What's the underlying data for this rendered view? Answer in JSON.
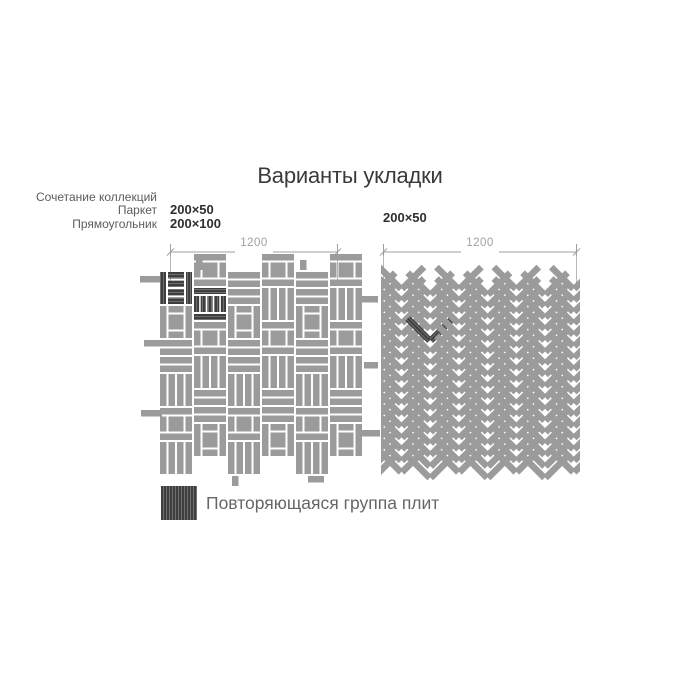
{
  "title": "Варианты укладки",
  "left_diagram": {
    "collection_label_lines": [
      "Сочетание коллекций",
      "Паркет",
      "Прямоугольник"
    ],
    "tile_sizes": [
      "200×50",
      "200×100"
    ],
    "dimension_label": "1200",
    "pattern_type": "basketweave-parquet"
  },
  "right_diagram": {
    "tile_sizes": [
      "200×50"
    ],
    "dimension_label": "1200",
    "pattern_type": "herringbone-45"
  },
  "legend": {
    "label": "Повторяющаяся группа плит"
  },
  "colors": {
    "tile_gray": "#9b9b9b",
    "grout_white": "#ffffff",
    "highlight_dark": "#3e3e3e",
    "highlight_grain": "#757575",
    "dimension_gray": "#9f9f9f",
    "title_text": "#3a3a3a",
    "label_gray": "#5c5c5c",
    "size_text": "#2e2e2e",
    "legend_text": "#666666"
  },
  "patterns": {
    "left": {
      "type": "basketweave",
      "module_mm": 200,
      "modules_x": 6,
      "modules_y": 6,
      "dark_modules": 2
    },
    "right": {
      "type": "herringbone-45",
      "tile_mm": "200×50",
      "columns": 8,
      "rows": 17,
      "dark_tiles": 2
    }
  }
}
